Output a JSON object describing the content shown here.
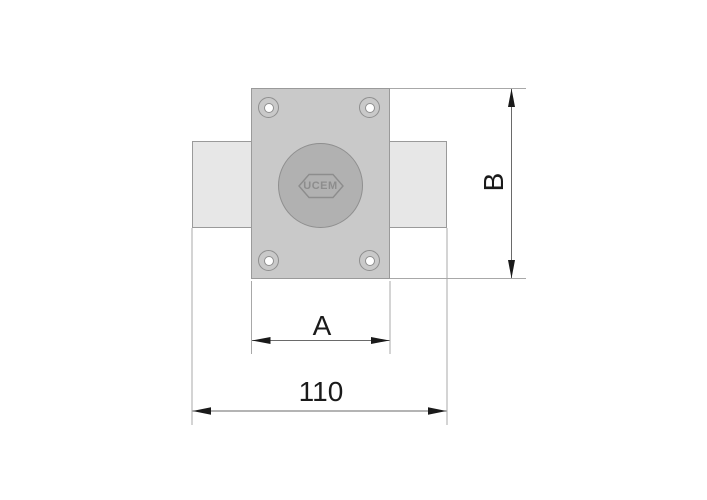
{
  "drawing": {
    "type": "technical-dimension-drawing",
    "subject": "rim-lock-front-view",
    "brand": "UCEM",
    "dimensions": {
      "plate_width": {
        "label": "A"
      },
      "plate_height": {
        "label": "B"
      },
      "overall_width": {
        "label": "110"
      }
    },
    "colors": {
      "background": "#ffffff",
      "body_fill": "#e7e7e7",
      "plate_fill": "#c9c9c9",
      "knob_fill": "#b1b1b1",
      "outline": "#9a9a9a",
      "outline_dark": "#8f8f8f",
      "extension_line": "#a8a8a8",
      "dimension_line": "#6a6a6a",
      "arrow": "#1a1a1a",
      "text": "#1a1a1a",
      "logo": "#8d8d8d"
    }
  }
}
